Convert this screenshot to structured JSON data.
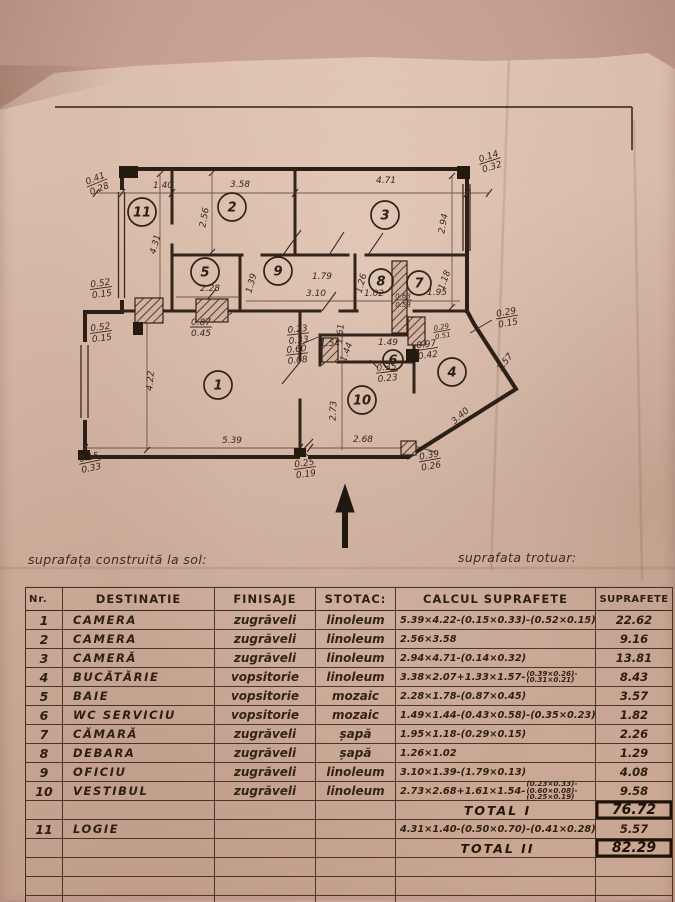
{
  "page": {
    "caption_left": "suprafața construită la sol:",
    "caption_right": "suprafata trotuar:"
  },
  "colors": {
    "paper": "#d6b7a5",
    "ink": "#32241a",
    "photo_background": "#c49e90"
  },
  "plan": {
    "north_arrow": "up",
    "rooms": [
      {
        "n": "11",
        "x": 142,
        "y": 212
      },
      {
        "n": "2",
        "x": 232,
        "y": 207
      },
      {
        "n": "3",
        "x": 385,
        "y": 215
      },
      {
        "n": "5",
        "x": 205,
        "y": 272
      },
      {
        "n": "9",
        "x": 278,
        "y": 271
      },
      {
        "n": "8",
        "x": 381,
        "y": 281,
        "r": 12
      },
      {
        "n": "7",
        "x": 419,
        "y": 283,
        "r": 12
      },
      {
        "n": "6",
        "x": 393,
        "y": 360,
        "r": 10
      },
      {
        "n": "1",
        "x": 218,
        "y": 385
      },
      {
        "n": "10",
        "x": 362,
        "y": 400
      },
      {
        "n": "4",
        "x": 452,
        "y": 372
      }
    ],
    "dims": [
      {
        "t": "1.40",
        "x": 163,
        "y": 188
      },
      {
        "t": "3.58",
        "x": 240,
        "y": 187
      },
      {
        "t": "4.71",
        "x": 386,
        "y": 183
      },
      {
        "t": "2.56",
        "x": 207,
        "y": 218,
        "r": -80
      },
      {
        "t": "2.94",
        "x": 446,
        "y": 224,
        "r": -80
      },
      {
        "t": "4.31",
        "x": 158,
        "y": 245,
        "r": -75
      },
      {
        "t": "2.28",
        "x": 210,
        "y": 291
      },
      {
        "t": "1.39",
        "x": 254,
        "y": 284,
        "r": -75
      },
      {
        "t": "1.79",
        "x": 322,
        "y": 279
      },
      {
        "t": "3.10",
        "x": 316,
        "y": 296
      },
      {
        "t": "1.26",
        "x": 364,
        "y": 284,
        "r": -75
      },
      {
        "t": "1.02",
        "x": 374,
        "y": 296
      },
      {
        "t": "1.18",
        "x": 447,
        "y": 281,
        "r": -70
      },
      {
        "t": "1.95",
        "x": 437,
        "y": 295
      },
      {
        "t": "1.61",
        "x": 343,
        "y": 334,
        "r": -85
      },
      {
        "t": "1.54",
        "x": 330,
        "y": 346
      },
      {
        "t": "1.49",
        "x": 388,
        "y": 345
      },
      {
        "t": "1.44",
        "x": 349,
        "y": 353,
        "r": -70
      },
      {
        "t": "1.57",
        "x": 507,
        "y": 364,
        "r": -52
      },
      {
        "t": "4.22",
        "x": 153,
        "y": 381,
        "r": -85
      },
      {
        "t": "2.73",
        "x": 336,
        "y": 411,
        "r": -87
      },
      {
        "t": "3.40",
        "x": 462,
        "y": 418,
        "r": -41
      },
      {
        "t": "5.39",
        "x": 232,
        "y": 443
      },
      {
        "t": "2.68",
        "x": 363,
        "y": 442
      },
      {
        "a": "0.41",
        "b": "0.28",
        "x": 97,
        "y": 183,
        "r": -22
      },
      {
        "a": "0.14",
        "b": "0.32",
        "x": 490,
        "y": 161,
        "r": -18
      },
      {
        "a": "0.52",
        "b": "0.15",
        "x": 101,
        "y": 288,
        "r": -8
      },
      {
        "a": "0.52",
        "b": "0.15",
        "x": 101,
        "y": 332,
        "r": -8
      },
      {
        "a": "0.87",
        "b": "0.45",
        "x": 201,
        "y": 327
      },
      {
        "a": "0.23",
        "b": "0.33",
        "x": 298,
        "y": 334,
        "r": -6
      },
      {
        "a": "0.60",
        "b": "0.08",
        "x": 297,
        "y": 354,
        "r": -6
      },
      {
        "a": "0.63",
        "b": "0.58",
        "x": 403,
        "y": 300,
        "s": 0.78
      },
      {
        "a": "0.29",
        "b": "0.15",
        "x": 507,
        "y": 317,
        "r": -10
      },
      {
        "a": "0.29",
        "b": "0.51",
        "x": 442,
        "y": 331,
        "r": -10,
        "s": 0.78
      },
      {
        "a": "0.97",
        "b": "0.42",
        "x": 427,
        "y": 349,
        "r": -8
      },
      {
        "a": "0.35",
        "b": "0.23",
        "x": 387,
        "y": 372,
        "r": -6
      },
      {
        "a": "0.25",
        "b": "0.19",
        "x": 305,
        "y": 468,
        "r": -8
      },
      {
        "a": "0.39",
        "b": "0.26",
        "x": 430,
        "y": 460,
        "r": -10
      },
      {
        "a": "0.15",
        "b": "0.33",
        "x": 90,
        "y": 462,
        "r": -12
      }
    ]
  },
  "table": {
    "headers": [
      "Nr.",
      "DESTINATIE",
      "FINISAJE",
      "STOTAC:",
      "CALCUL SUPRAFETE",
      "SUPRAFETE"
    ],
    "rows": [
      {
        "nr": "1",
        "dest": "CAMERA",
        "fin": "zugrăveli",
        "st": "linoleum",
        "calc": "5.39×4.22-(0.15×0.33)-(0.52×0.15)",
        "sup": "22.62"
      },
      {
        "nr": "2",
        "dest": "CAMERA",
        "fin": "zugrăveli",
        "st": "linoleum",
        "calc": "2.56×3.58",
        "sup": "9.16"
      },
      {
        "nr": "3",
        "dest": "CAMERĂ",
        "fin": "zugrăveli",
        "st": "linoleum",
        "calc": "2.94×4.71-(0.14×0.32)",
        "sup": "13.81"
      },
      {
        "nr": "4",
        "dest": "BUCĂTĂRIE",
        "fin": "vopsitorie",
        "st": "linoleum",
        "calc": "3.38×2.07+1.33×1.57-",
        "stack": [
          "(0.39×0.26)-",
          "(0.31×0.21)"
        ],
        "sup": "8.43"
      },
      {
        "nr": "5",
        "dest": "BAIE",
        "fin": "vopsitorie",
        "st": "mozaic",
        "calc": "2.28×1.78-(0.87×0.45)",
        "sup": "3.57"
      },
      {
        "nr": "6",
        "dest": "WC SERVICIU",
        "fin": "vopsitorie",
        "st": "mozaic",
        "calc": "1.49×1.44-(0.43×0.58)-(0.35×0.23)",
        "sup": "1.82"
      },
      {
        "nr": "7",
        "dest": "CĂMARĂ",
        "fin": "zugrăveli",
        "st": "șapă",
        "calc": "1.95×1.18-(0.29×0.15)",
        "sup": "2.26"
      },
      {
        "nr": "8",
        "dest": "DEBARA",
        "fin": "zugrăveli",
        "st": "șapă",
        "calc": "1.26×1.02",
        "sup": "1.29"
      },
      {
        "nr": "9",
        "dest": "OFICIU",
        "fin": "zugrăveli",
        "st": "linoleum",
        "calc": "3.10×1.39-(1.79×0.13)",
        "sup": "4.08"
      },
      {
        "nr": "10",
        "dest": "VESTIBUL",
        "fin": "zugrăveli",
        "st": "linoleum",
        "calc": "2.73×2.68+1.61×1.54-",
        "stack": [
          "(0.23×0.33)-",
          "(0.60×0.08)-",
          "(0.25×0.19)"
        ],
        "sup": "9.58"
      },
      {
        "type": "total",
        "label": "TOTAL I",
        "sup": "76.72"
      },
      {
        "nr": "11",
        "dest": "LOGIE",
        "fin": "",
        "st": "",
        "calc": "4.31×1.40-(0.50×0.70)-(0.41×0.28)",
        "sup": "5.57"
      },
      {
        "type": "total",
        "label": "TOTAL II",
        "sup": "82.29"
      },
      {
        "type": "empty"
      },
      {
        "type": "empty"
      },
      {
        "type": "empty"
      }
    ]
  }
}
